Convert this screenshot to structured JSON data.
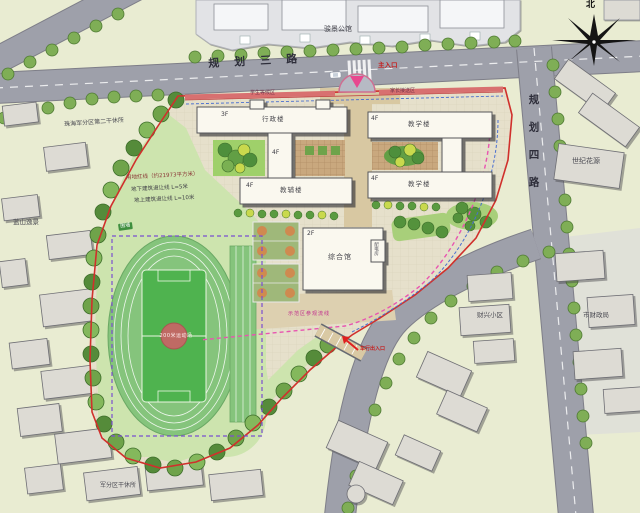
{
  "compass": {
    "north": "北"
  },
  "roads": {
    "north_road": "规划三路",
    "east_road": "规划四路",
    "main_entrance": "主入口",
    "vehicle_entrance": "车行出入口"
  },
  "annotations": {
    "red_line": "用地红线（约21973平方米）",
    "setback_underground": "地下建筑退让线 L=5米",
    "setback_above": "地上建筑退让线 L=10米",
    "fence": "围墙",
    "visit_route": "示范区参观流线",
    "waiting_left": "学生等候区",
    "waiting_right": "家长接送区"
  },
  "campus": {
    "admin_floors": "3F",
    "admin_name": "行政楼",
    "aux_floors": "4F",
    "aux_name": "教辅楼",
    "teach_a_floors": "4F",
    "teach_a_name": "教学楼",
    "teach_b_floors": "4F",
    "teach_b_name": "教学楼",
    "link_floors": "4F",
    "gym_floors": "2F",
    "gym_name": "综合馆",
    "power_room": "配电房",
    "track_name": "200米运动场"
  },
  "surroundings": {
    "north_complex": "骏景公馆",
    "northeast_complex": "世纪花源",
    "west_complex": "珠海军分区第二干休所",
    "west_residence": "蓝山逸景",
    "southwest_residence": "军分区干休所",
    "southeast_residence": "财兴小区",
    "southeast_gov": "市财政局"
  },
  "colors": {
    "site_boundary": "#d0302c",
    "visit_route_line": "#e855b0",
    "setback_line": "#7a4fd0",
    "road_gray": "#9ea0aa",
    "field_green": "#4fb34f",
    "track_green": "#85c47c",
    "tree_green": "#6fa34a",
    "entrance_red": "#e02020",
    "paving_tan": "#d8c8a2"
  }
}
